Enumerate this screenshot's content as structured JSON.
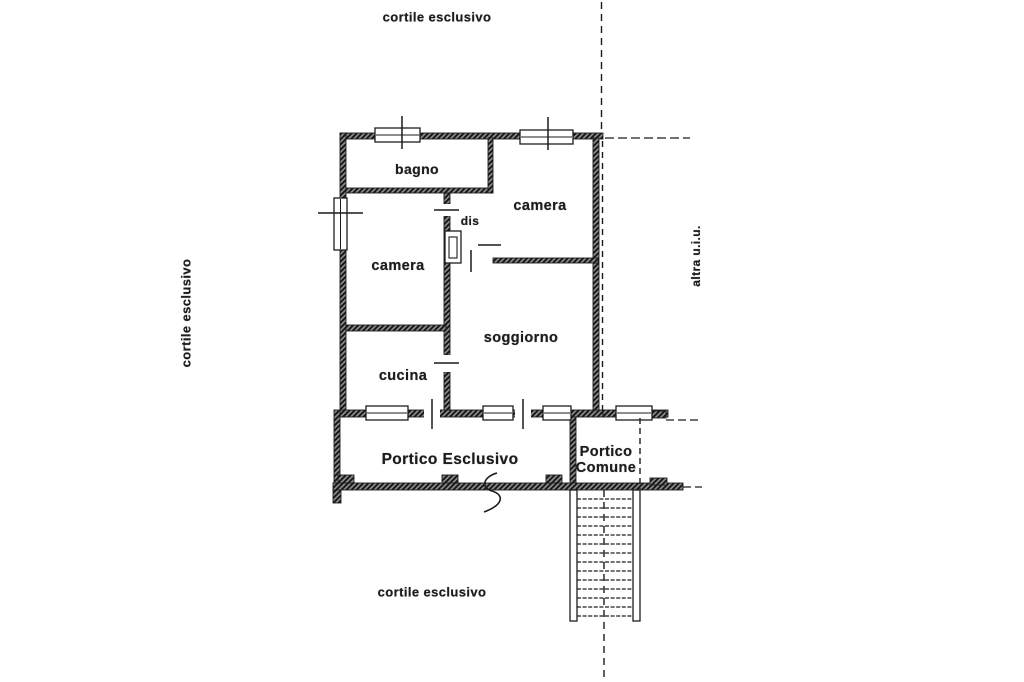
{
  "page": {
    "background": "#ffffff",
    "ink": "#1c1c1c"
  },
  "annotations": {
    "courtyard_top": "cortile esclusivo",
    "courtyard_left": "cortile esclusivo",
    "courtyard_bottom": "cortile esclusivo",
    "adjacent_unit": "altra u.i.u."
  },
  "rooms": {
    "bagno": "bagno",
    "camera_right": "camera",
    "camera_left": "camera",
    "dis": "dis",
    "soggiorno": "soggiorno",
    "cucina": "cucina",
    "portico_esclusivo": "Portico Esclusivo",
    "portico_comune_line1": "Portico",
    "portico_comune_line2": "Comune"
  }
}
